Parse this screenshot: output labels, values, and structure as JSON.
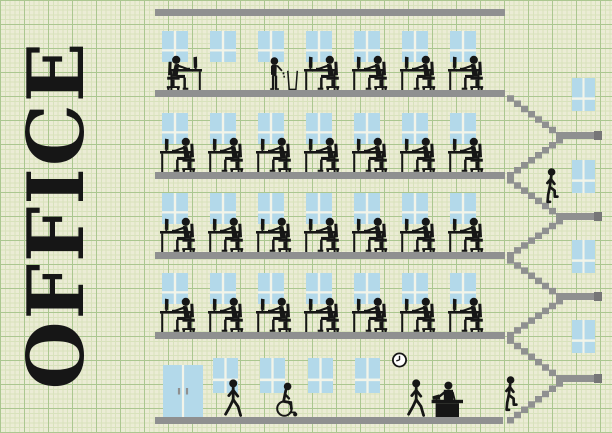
{
  "title": "OFFICE",
  "colors": {
    "background": "#ebecd5",
    "grid_minor": "#d8e2bc",
    "grid_major": "#abc790",
    "structure": "#8f9090",
    "structure_dark": "#767677",
    "window": "#b3d9ea",
    "window_frame": "#f2f4e9",
    "figure": "#161616",
    "clock_face": "#ffffff"
  },
  "scene": {
    "floors": [
      {
        "id": "top-floor",
        "windows": 7,
        "seated_workers": 5,
        "facing_right_workers": 1,
        "standing_person_with_trash_bin": true
      },
      {
        "id": "fourth-floor",
        "windows": 7,
        "seated_workers": 7
      },
      {
        "id": "third-floor",
        "windows": 7,
        "seated_workers": 7
      },
      {
        "id": "second-floor",
        "windows": 7,
        "seated_workers": 7
      },
      {
        "id": "ground-floor",
        "windows": 4,
        "entrance_door": true,
        "walking_people": 2,
        "wheelchair_user": true,
        "receptionist_at_desk": true,
        "wall_clock": true,
        "person_entering_stairs": true
      }
    ],
    "stairwell": {
      "landings": 4,
      "flights": 8,
      "windows": 4,
      "person_climbing": true
    },
    "pictograms": [
      "worker-at-desk-icon",
      "monitor-icon",
      "keyboard-icon",
      "office-chair-icon",
      "standing-person-trash-icon",
      "trash-bin-icon",
      "walking-person-icon",
      "wheelchair-person-icon",
      "stair-climber-icon",
      "reception-desk-icon",
      "wall-clock-icon",
      "entrance-door-icon",
      "window-icon"
    ]
  }
}
